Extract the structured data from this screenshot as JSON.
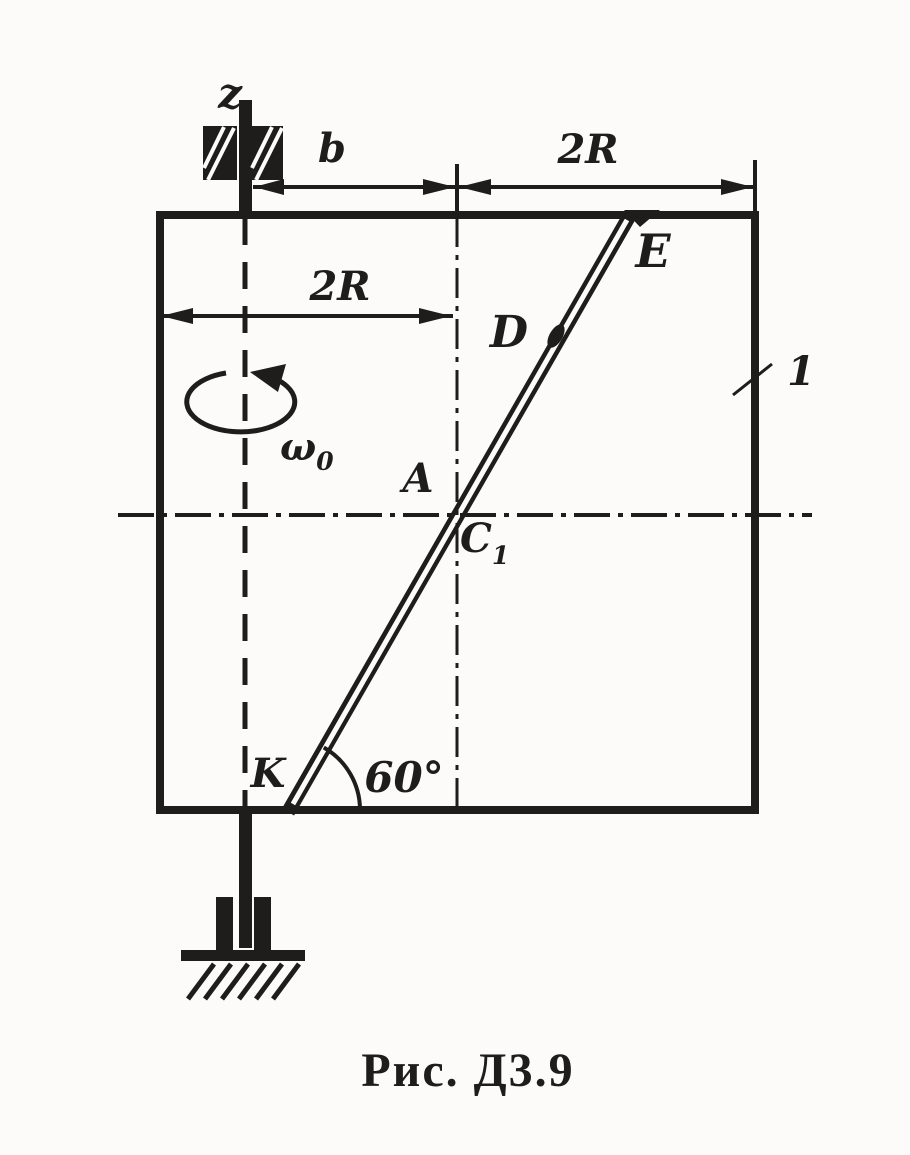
{
  "figure": {
    "caption": "Рис. Д3.9",
    "colors": {
      "ink": "#1f1d1b",
      "paper": "#fcfbf9"
    },
    "labels": {
      "axis_z": "z",
      "dim_b": "b",
      "dim_2R_top": "2R",
      "dim_2R_left": "2R",
      "omega": "ω",
      "omega_sub": "0",
      "angle_60": "60°",
      "body_1": "1",
      "point_A": "A",
      "point_C": "C",
      "point_C_sub": "1",
      "point_D": "D",
      "point_E": "E",
      "point_K": "K"
    }
  }
}
